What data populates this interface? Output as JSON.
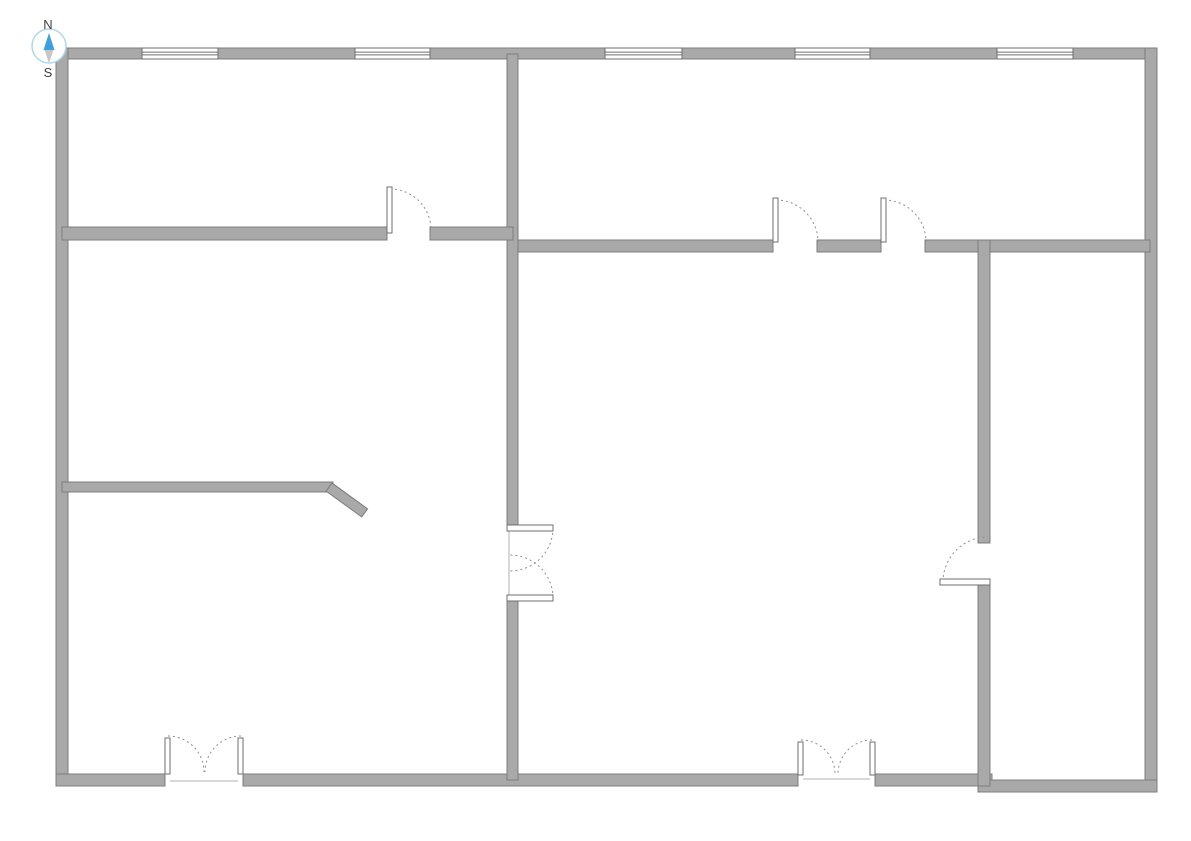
{
  "title": "floor-plan",
  "compass": {
    "north_label": "N",
    "south_label": "S"
  },
  "colors": {
    "background": "#ffffff",
    "wall_fill": "#a9a9a9",
    "wall_outline": "#7d7d7d",
    "window_fill": "#ffffff",
    "window_line": "#6f6f6f",
    "door_leaf_fill": "#ffffff",
    "door_leaf_outline": "#6f6f6f",
    "door_arc": "#8f8f8f",
    "door_line": "#b0b0b0",
    "compass_ring": "#aed7ec",
    "compass_fill": "#ffffff",
    "compass_north": "#3f9fdf",
    "compass_south": "#c6c6c6",
    "label_color": "#3f3f3f"
  },
  "floor_plan": {
    "canvas": {
      "width": 1191,
      "height": 841
    },
    "walls": [
      {
        "name": "exterior-wall-top",
        "x": 56,
        "y": 48,
        "w": 1101,
        "h": 11
      },
      {
        "name": "exterior-wall-left",
        "x": 56,
        "y": 48,
        "w": 12,
        "h": 738
      },
      {
        "name": "exterior-wall-right",
        "x": 1145,
        "y": 48,
        "w": 12,
        "h": 744
      },
      {
        "name": "exterior-wall-bottom-a",
        "x": 56,
        "y": 774,
        "w": 109,
        "h": 12
      },
      {
        "name": "exterior-wall-bottom-b",
        "x": 243,
        "y": 774,
        "w": 555,
        "h": 12
      },
      {
        "name": "exterior-wall-bottom-c",
        "x": 875,
        "y": 774,
        "w": 117,
        "h": 12
      },
      {
        "name": "exterior-wall-bottom-d",
        "x": 978,
        "y": 780,
        "w": 179,
        "h": 12
      },
      {
        "name": "interior-wall-center-vertical-upper",
        "x": 507,
        "y": 54,
        "w": 11,
        "h": 471
      },
      {
        "name": "interior-wall-center-vertical-lower",
        "x": 507,
        "y": 600,
        "w": 11,
        "h": 180
      },
      {
        "name": "interior-wall-left-divider-a",
        "x": 62,
        "y": 227,
        "w": 325,
        "h": 13
      },
      {
        "name": "interior-wall-left-divider-b",
        "x": 430,
        "y": 227,
        "w": 83,
        "h": 13
      },
      {
        "name": "interior-wall-right-divider-a",
        "x": 518,
        "y": 240,
        "w": 255,
        "h": 12
      },
      {
        "name": "interior-wall-right-divider-b",
        "x": 817,
        "y": 240,
        "w": 64,
        "h": 12
      },
      {
        "name": "interior-wall-right-divider-c",
        "x": 925,
        "y": 240,
        "w": 225,
        "h": 12
      },
      {
        "name": "interior-wall-right-vertical-upper",
        "x": 978,
        "y": 240,
        "w": 12,
        "h": 303
      },
      {
        "name": "interior-wall-right-vertical-lower",
        "x": 978,
        "y": 585,
        "w": 12,
        "h": 201
      },
      {
        "name": "interior-wall-partial-left",
        "x": 62,
        "y": 482,
        "w": 271,
        "h": 10
      }
    ],
    "angled_walls": [
      {
        "name": "interior-wall-angled-stub",
        "x": 332,
        "y": 483,
        "w": 44,
        "h": 10,
        "angle": 36
      }
    ],
    "windows": [
      {
        "name": "window",
        "x": 142,
        "y": 48,
        "w": 76,
        "h": 11
      },
      {
        "name": "window",
        "x": 355,
        "y": 48,
        "w": 75,
        "h": 11
      },
      {
        "name": "window",
        "x": 605,
        "y": 48,
        "w": 77,
        "h": 11
      },
      {
        "name": "window",
        "x": 795,
        "y": 48,
        "w": 75,
        "h": 11
      },
      {
        "name": "window",
        "x": 997,
        "y": 48,
        "w": 76,
        "h": 11
      }
    ],
    "door_leaves": [
      {
        "name": "door-leaf",
        "x": 387,
        "y": 187,
        "w": 5,
        "h": 46
      },
      {
        "name": "door-leaf",
        "x": 773,
        "y": 198,
        "w": 5,
        "h": 44
      },
      {
        "name": "door-leaf",
        "x": 881,
        "y": 198,
        "w": 5,
        "h": 44
      },
      {
        "name": "door-leaf",
        "x": 940,
        "y": 579,
        "w": 50,
        "h": 6
      },
      {
        "name": "door-leaf",
        "x": 507,
        "y": 525,
        "w": 46,
        "h": 6
      },
      {
        "name": "door-leaf",
        "x": 507,
        "y": 595,
        "w": 46,
        "h": 6
      },
      {
        "name": "door-leaf",
        "x": 165,
        "y": 738,
        "w": 5,
        "h": 36
      },
      {
        "name": "door-leaf",
        "x": 238,
        "y": 738,
        "w": 5,
        "h": 36
      },
      {
        "name": "door-leaf",
        "x": 798,
        "y": 742,
        "w": 5,
        "h": 33
      },
      {
        "name": "door-leaf",
        "x": 870,
        "y": 742,
        "w": 5,
        "h": 33
      }
    ],
    "door_arcs": [
      {
        "name": "door-swing-arc",
        "x1": 390,
        "y1": 189,
        "x2": 431,
        "y2": 230,
        "r": 41,
        "sweep": 1
      },
      {
        "name": "door-swing-arc",
        "x1": 776,
        "y1": 200,
        "x2": 818,
        "y2": 242,
        "r": 42,
        "sweep": 1
      },
      {
        "name": "door-swing-arc",
        "x1": 884,
        "y1": 200,
        "x2": 926,
        "y2": 242,
        "r": 42,
        "sweep": 1
      },
      {
        "name": "door-swing-arc",
        "x1": 943,
        "y1": 582,
        "x2": 988,
        "y2": 537,
        "r": 45,
        "sweep": 1
      },
      {
        "name": "door-swing-arc",
        "x1": 553,
        "y1": 528,
        "x2": 510,
        "y2": 571,
        "r": 43,
        "sweep": 1
      },
      {
        "name": "door-swing-arc",
        "x1": 553,
        "y1": 598,
        "x2": 510,
        "y2": 555,
        "r": 43,
        "sweep": 0
      },
      {
        "name": "door-swing-arc",
        "x1": 168,
        "y1": 736,
        "x2": 204,
        "y2": 772,
        "r": 36,
        "sweep": 1
      },
      {
        "name": "door-swing-arc",
        "x1": 241,
        "y1": 736,
        "x2": 205,
        "y2": 772,
        "r": 36,
        "sweep": 0
      },
      {
        "name": "door-swing-arc",
        "x1": 801,
        "y1": 740,
        "x2": 835,
        "y2": 774,
        "r": 34,
        "sweep": 1
      },
      {
        "name": "door-swing-arc",
        "x1": 872,
        "y1": 740,
        "x2": 838,
        "y2": 774,
        "r": 34,
        "sweep": 0
      }
    ],
    "door_lines": [
      {
        "name": "door-opening-line",
        "x1": 509,
        "y1": 531,
        "x2": 509,
        "y2": 595
      },
      {
        "name": "door-threshold-line",
        "x1": 170,
        "y1": 781,
        "x2": 238,
        "y2": 781
      },
      {
        "name": "door-threshold-line",
        "x1": 803,
        "y1": 779,
        "x2": 870,
        "y2": 779
      }
    ]
  }
}
